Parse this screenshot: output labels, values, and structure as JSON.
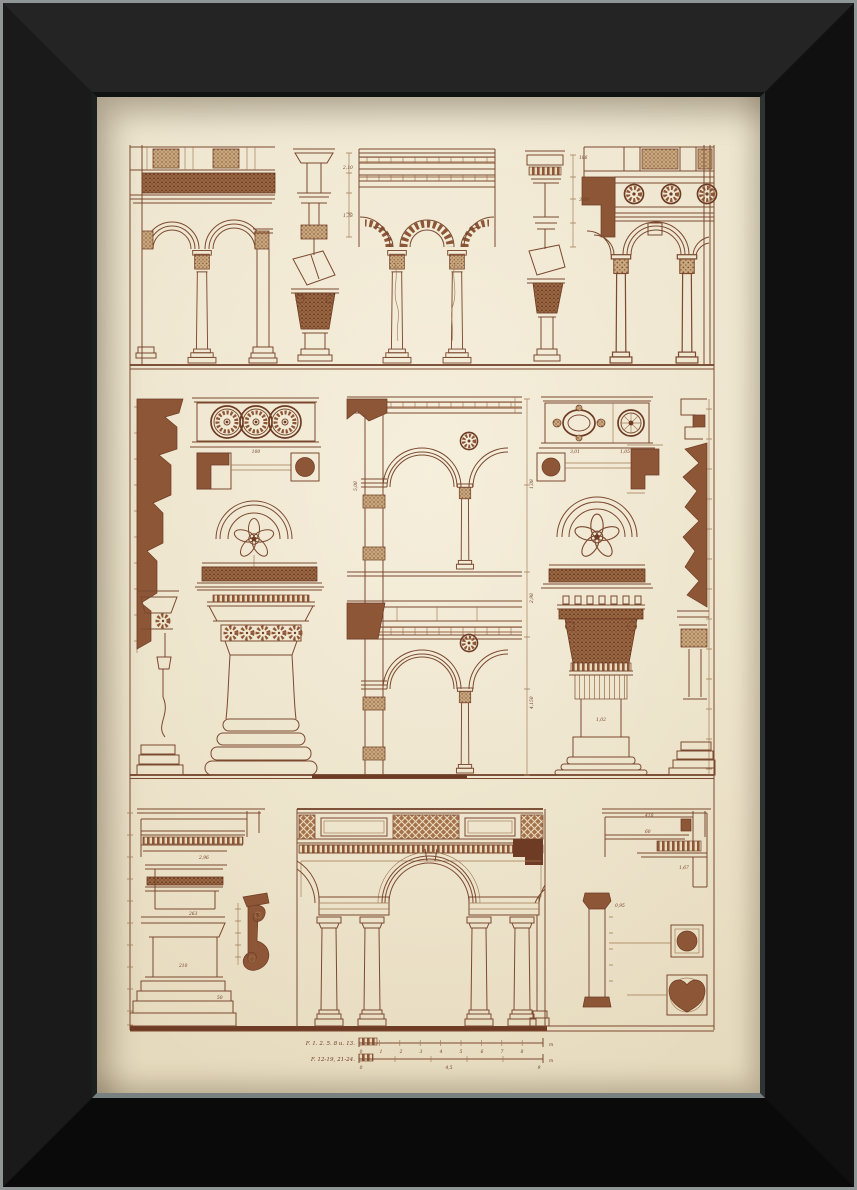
{
  "artwork": {
    "type": "framed architectural engraving",
    "subject": "Renaissance arcades and arches plate",
    "frame_color": "#121212",
    "paper_color": "#ece3cb",
    "ink_color": "#7b4930",
    "wash_color": "#8d5637"
  },
  "plate": {
    "captions": {
      "line1": "F. 1. 2. 5. 8 u. 13.",
      "line2": "F. 12-19, 21-24."
    },
    "units": {
      "u1": "m",
      "u2": "m"
    },
    "scale1": [
      "0",
      "1",
      "2",
      "3",
      "4",
      "5",
      "6",
      "7",
      "8"
    ],
    "scale2": [
      "0",
      "4,5",
      "9"
    ],
    "dims": [
      "2,10",
      "1,38",
      "100",
      "1,08",
      "2,98",
      "4,150",
      "5,08",
      "3,01",
      "1,05",
      "1,02",
      "2,96",
      "263",
      "210",
      "50",
      "1,67",
      "60",
      "410",
      "186",
      "3,00",
      "0,95"
    ]
  }
}
